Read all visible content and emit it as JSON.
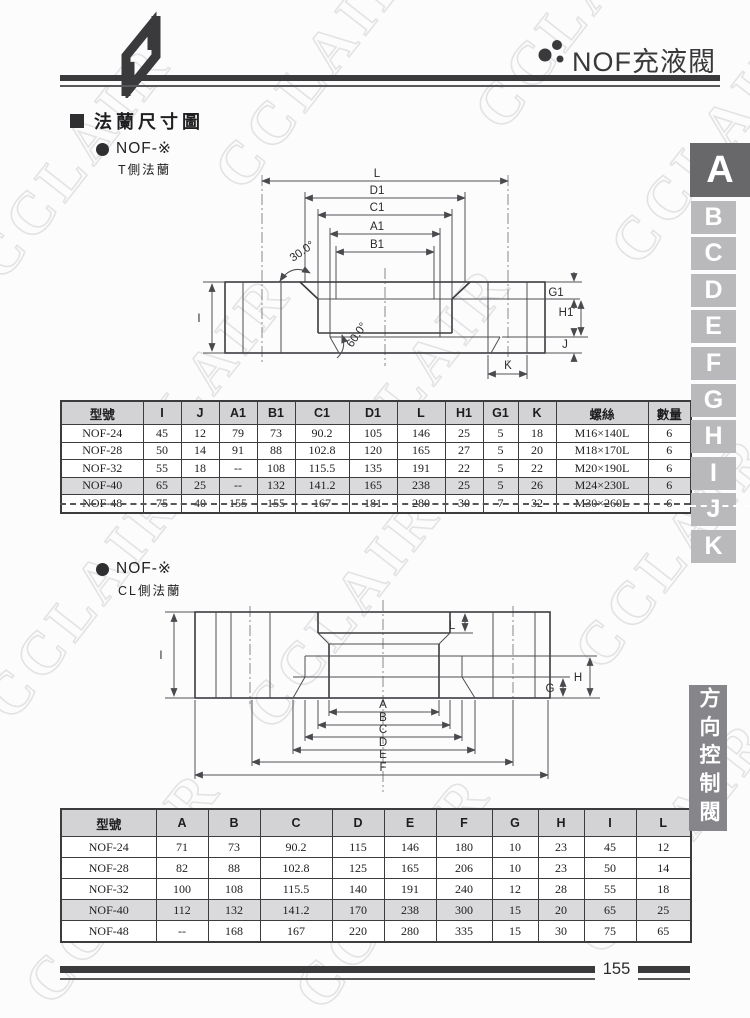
{
  "header": {
    "title": "NOF充液閥"
  },
  "section": {
    "heading": "法蘭尺寸圖"
  },
  "flange1": {
    "bullet_label": "NOF-※",
    "side_label": "T側法蘭"
  },
  "flange2": {
    "bullet_label": "NOF-※",
    "side_label": "CL側法蘭"
  },
  "diagram1": {
    "dims": {
      "L": "L",
      "D1": "D1",
      "C1": "C1",
      "A1": "A1",
      "B1": "B1",
      "angle_top": "30.0°",
      "angle_bottom": "60.0°",
      "G1": "G1",
      "H1": "H1",
      "I": "I",
      "J": "J",
      "K": "K"
    }
  },
  "diagram2": {
    "dims": {
      "L": "L",
      "I": "I",
      "H": "H",
      "G": "G",
      "A": "A",
      "B": "B",
      "C": "C",
      "D": "D",
      "E": "E",
      "F": "F"
    }
  },
  "table1": {
    "headers": [
      "型號",
      "I",
      "J",
      "A1",
      "B1",
      "C1",
      "D1",
      "L",
      "H1",
      "G1",
      "K",
      "螺絲",
      "數量"
    ],
    "rows": [
      [
        "NOF-24",
        "45",
        "12",
        "79",
        "73",
        "90.2",
        "105",
        "146",
        "25",
        "5",
        "18",
        "M16×140L",
        "6"
      ],
      [
        "NOF-28",
        "50",
        "14",
        "91",
        "88",
        "102.8",
        "120",
        "165",
        "27",
        "5",
        "20",
        "M18×170L",
        "6"
      ],
      [
        "NOF-32",
        "55",
        "18",
        "--",
        "108",
        "115.5",
        "135",
        "191",
        "22",
        "5",
        "22",
        "M20×190L",
        "6"
      ],
      [
        "NOF-40",
        "65",
        "25",
        "--",
        "132",
        "141.2",
        "165",
        "238",
        "25",
        "5",
        "26",
        "M24×230L",
        "6"
      ],
      [
        "NOF-48",
        "75",
        "40",
        "155",
        "155",
        "167",
        "181",
        "280",
        "30",
        "7",
        "32",
        "M30×260L",
        "6"
      ]
    ],
    "highlight_model": "NOF-40"
  },
  "table2": {
    "headers": [
      "型號",
      "A",
      "B",
      "C",
      "D",
      "E",
      "F",
      "G",
      "H",
      "I",
      "L"
    ],
    "rows": [
      [
        "NOF-24",
        "71",
        "73",
        "90.2",
        "115",
        "146",
        "180",
        "10",
        "23",
        "45",
        "12"
      ],
      [
        "NOF-28",
        "82",
        "88",
        "102.8",
        "125",
        "165",
        "206",
        "10",
        "23",
        "50",
        "14"
      ],
      [
        "NOF-32",
        "100",
        "108",
        "115.5",
        "140",
        "191",
        "240",
        "12",
        "28",
        "55",
        "18"
      ],
      [
        "NOF-40",
        "112",
        "132",
        "141.2",
        "170",
        "238",
        "300",
        "15",
        "20",
        "65",
        "25"
      ],
      [
        "NOF-48",
        "--",
        "168",
        "167",
        "220",
        "280",
        "335",
        "15",
        "30",
        "75",
        "65"
      ]
    ],
    "highlight_model": "NOF-40"
  },
  "sidebar": {
    "tabs": [
      "A",
      "B",
      "C",
      "D",
      "E",
      "F",
      "G",
      "H",
      "I",
      "J",
      "K"
    ],
    "active_tab": "A",
    "category_label": "方向控制閥"
  },
  "footer": {
    "page_number": "155"
  },
  "watermark": {
    "text": "CCLAIR"
  },
  "colors": {
    "bar": "#3a3a3c",
    "tab_bg": "#b9b9bc",
    "tab_active_bg": "#68686b",
    "category_bg": "#85858a",
    "table_header_bg": "#d3d3d5",
    "table_highlight_bg": "#dadadc"
  }
}
